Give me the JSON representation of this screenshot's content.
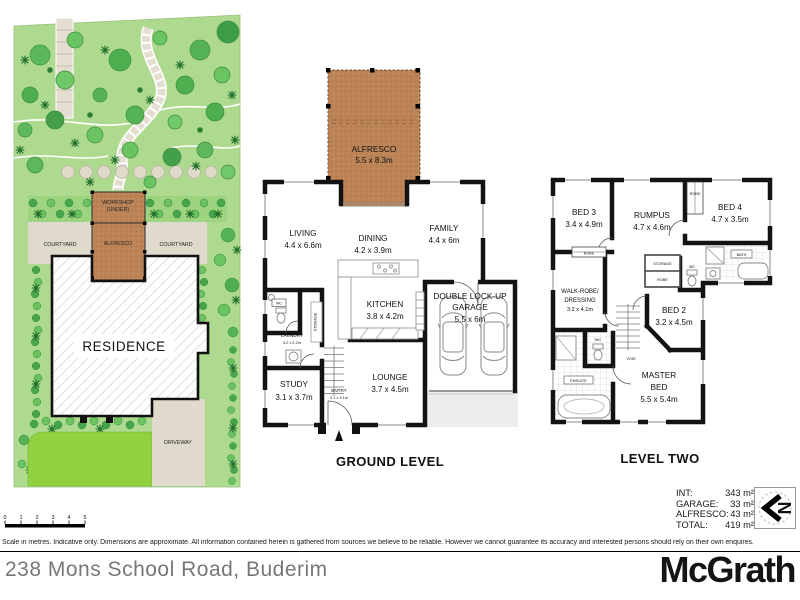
{
  "site_plan": {
    "workshop_label_1": "WORKSHOP",
    "workshop_label_2": "(UNDER)",
    "alfresco_label": "ALFRESCO",
    "courtyard_left_label": "COURTYARD",
    "courtyard_right_label": "COURTYARD",
    "residence_label": "RESIDENCE",
    "driveway_label": "DRIVEWAY"
  },
  "ground_level": {
    "title": "GROUND LEVEL",
    "alfresco": {
      "name": "ALFRESCO",
      "dims": "5.5 x 8.3m"
    },
    "living": {
      "name": "LIVING",
      "dims": "4.4 x 6.6m"
    },
    "dining": {
      "name": "DINING",
      "dims": "4.2 x 3.9m"
    },
    "family": {
      "name": "FAMILY",
      "dims": "4.4 x 6m"
    },
    "kitchen": {
      "name": "KITCHEN",
      "dims": "3.8 x 4.2m"
    },
    "garage": {
      "name_line1": "DOUBLE LOCK-UP",
      "name_line2": "GARAGE",
      "dims": "5.5 x 6m"
    },
    "laundry": {
      "name": "LAUNDRY",
      "dims": "3.2 x 2.2m"
    },
    "study": {
      "name": "STUDY",
      "dims": "3.1 x 3.7m"
    },
    "entry": {
      "name": "ENTRY",
      "dims": "2.1 x 3.1m"
    },
    "lounge": {
      "name": "LOUNGE",
      "dims": "3.7 x 4.5m"
    },
    "wc_label": "WC",
    "storage_label": "STORAGE"
  },
  "level_two": {
    "title": "LEVEL TWO",
    "bed3": {
      "name": "BED 3",
      "dims": "3.4 x 4.9m"
    },
    "rumpus": {
      "name": "RUMPUS",
      "dims": "4.7 x 4.6m"
    },
    "bed4": {
      "name": "BED 4",
      "dims": "4.7 x 3.5m"
    },
    "walkrobe": {
      "name_line1": "WALK-ROBE/",
      "name_line2": "DRESSING",
      "dims": "3.2 x 4.1m"
    },
    "bed2": {
      "name": "BED 2",
      "dims": "3.2 x 4.5m"
    },
    "master": {
      "name_line1": "MASTER",
      "name_line2": "BED",
      "dims": "5.5 x 5.4m"
    },
    "ensuite_label": "ENSUITE",
    "bath_label": "BATH",
    "wc_label": "WC",
    "void_label": "VOID",
    "storage_label": "STORAGE",
    "robe_label": "ROBE"
  },
  "areas": {
    "int": {
      "label": "INT:",
      "value": "343 m²"
    },
    "garage": {
      "label": "GARAGE:",
      "value": "33 m²"
    },
    "alfresco": {
      "label": "ALFRESCO:",
      "value": "43 m²"
    },
    "total": {
      "label": "TOTAL:",
      "value": "419 m²"
    }
  },
  "compass": {
    "north_label": "N"
  },
  "scale_bar": {
    "ticks": [
      "0",
      "1",
      "2",
      "3",
      "4",
      "5"
    ]
  },
  "disclaimer": "Scale in metres. Indicative only. Dimensions are approximate. All information contained herein is gathered from sources we believe to be reliable. However we cannot guarantee its accuracy and interested persons should rely on their own enquires.",
  "footer": {
    "address": "238 Mons School Road, Buderim",
    "brand": "McGrath"
  },
  "colors": {
    "wall": "#131313",
    "alfresco_deck": "#bc8456",
    "garden_green": "#aeda90",
    "lawn_green": "#90d13f",
    "path_beige": "#dfdacb",
    "brand_black": "#141414"
  }
}
